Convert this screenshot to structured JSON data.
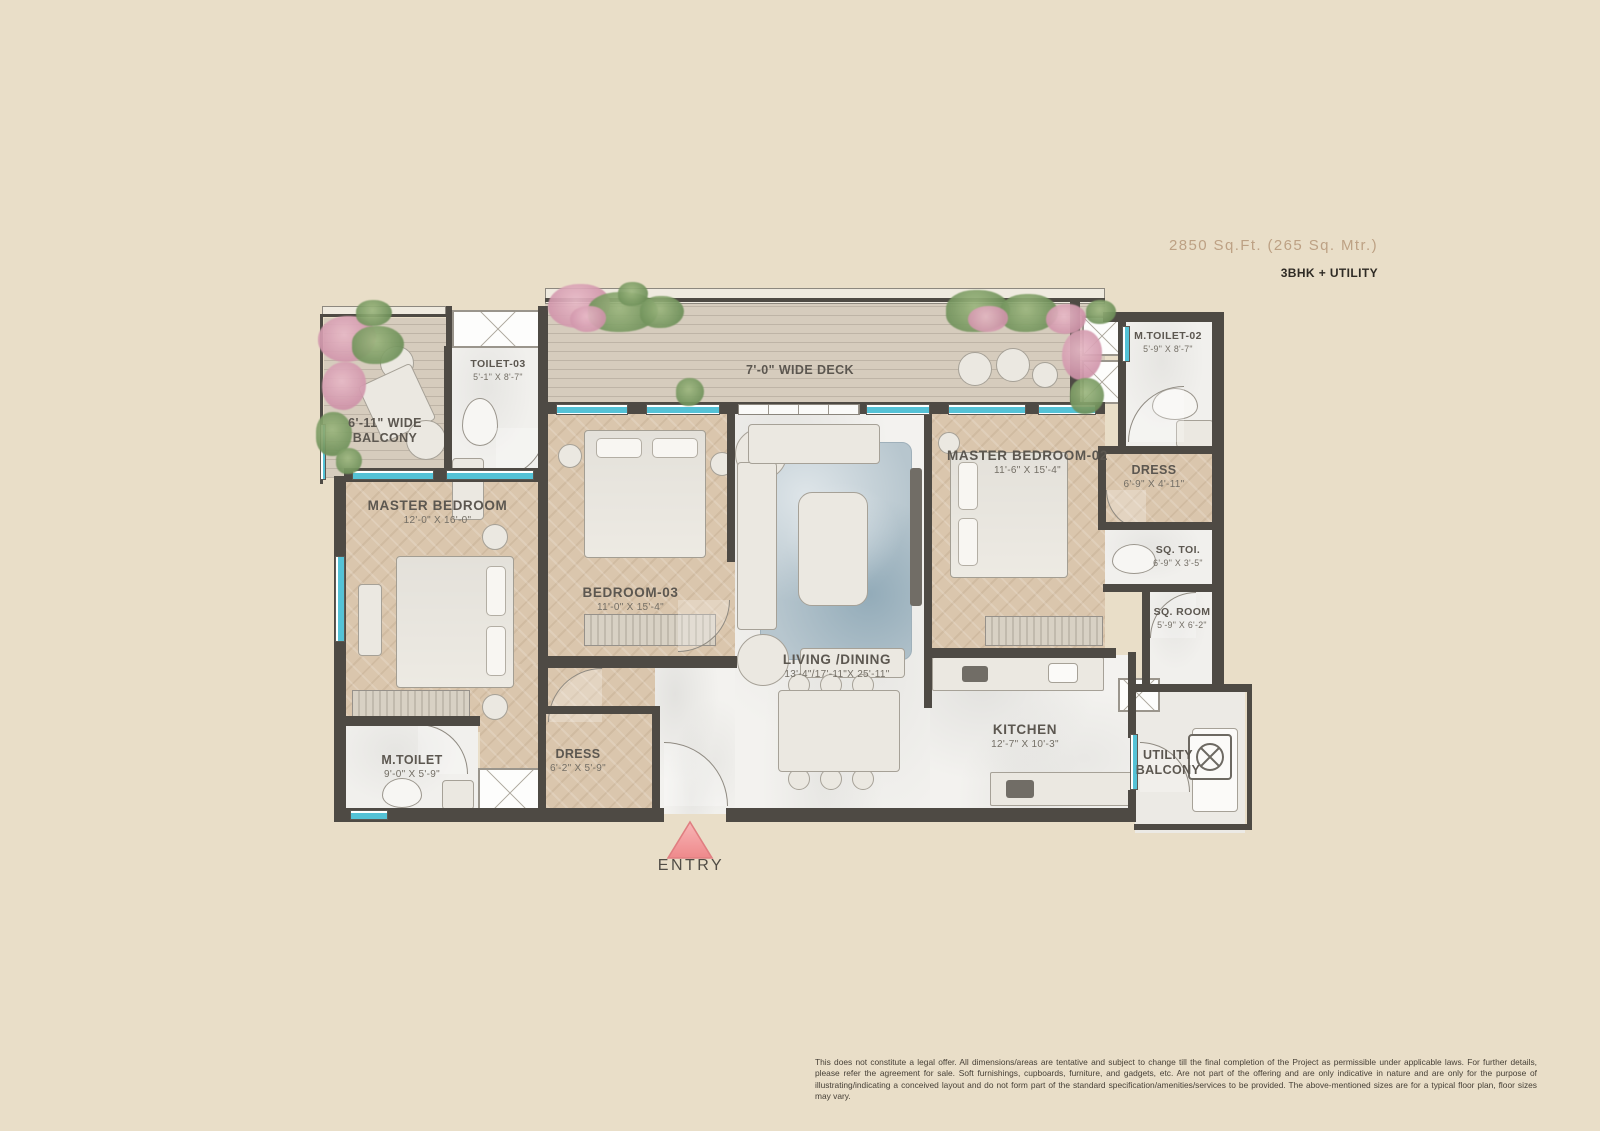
{
  "header": {
    "area": "2850 Sq.Ft.  (265 Sq. Mtr.)",
    "config": "3BHK + UTILITY"
  },
  "rooms": {
    "deck": {
      "name": "7'-0\" WIDE DECK",
      "dims": ""
    },
    "balcony": {
      "name": "6'-11\" WIDE BALCONY",
      "dims": ""
    },
    "toilet3": {
      "name": "TOILET-03",
      "dims": "5'-1\" X 8'-7\""
    },
    "mtoilet2": {
      "name": "M.TOILET-02",
      "dims": "5'-9\" X 8'-7\""
    },
    "master1": {
      "name": "MASTER BEDROOM",
      "dims": "12'-0\" X 16'-0\""
    },
    "bedroom3": {
      "name": "BEDROOM-03",
      "dims": "11'-0\" X 15'-4\""
    },
    "master2": {
      "name": "MASTER BEDROOM-02",
      "dims": "11'-6\" X 15'-4\""
    },
    "dress2": {
      "name": "DRESS",
      "dims": "6'-9\" X 4'-11\""
    },
    "sqtoi": {
      "name": "SQ. TOI.",
      "dims": "6'-9\" X 3'-5\""
    },
    "sqroom": {
      "name": "SQ. ROOM",
      "dims": "5'-9\" X 6'-2\""
    },
    "living": {
      "name": "LIVING /DINING",
      "dims": "13'-4\"/17'-11\"X 25'-11\""
    },
    "kitchen": {
      "name": "KITCHEN",
      "dims": "12'-7\" X 10'-3\""
    },
    "mtoilet": {
      "name": "M.TOILET",
      "dims": "9'-0\" X 5'-9\""
    },
    "dress1": {
      "name": "DRESS",
      "dims": "6'-2\" X 5'-9\""
    },
    "utility": {
      "name": "UTILITY BALCONY",
      "dims": ""
    }
  },
  "entry": {
    "label": "ENTRY"
  },
  "icons": {
    "washing_machine": "circle-with-x-drum",
    "entry_arrow": "pink-triangle-pointing-up"
  },
  "colors": {
    "background": "#e9dec8",
    "wall": "#4e4a44",
    "window_teal": "#54c2d6",
    "entry_pink": "#ee8b8d",
    "area_text": "#bda184"
  },
  "disclaimer": "This does not constitute a legal offer. All dimensions/areas are tentative and subject to change till the final completion of the Project as permissible under applicable laws. For further details, please refer the agreement for sale. Soft furnishings, cupboards, furniture, and gadgets, etc. Are not part of the offering and are only indicative in nature and are only for the purpose of illustrating/indicating a conceived layout and do not form part of the standard specification/amenities/services to be provided. The above-mentioned sizes are for a typical floor plan, floor sizes may vary."
}
